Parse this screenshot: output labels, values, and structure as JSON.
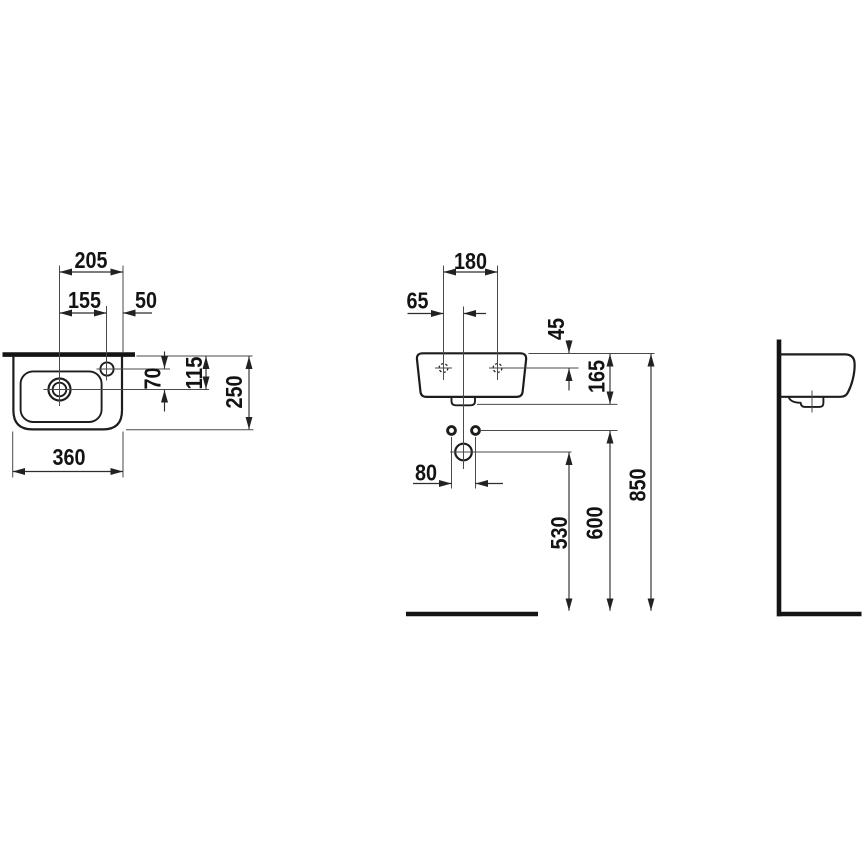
{
  "colors": {
    "outline": "#1d1d1b",
    "dimension_line": "#2e2e2e",
    "extension_line": "#4a4a4a",
    "text": "#131313",
    "background": "#ffffff"
  },
  "dims": {
    "top_view": {
      "d205": "205",
      "d155": "155",
      "d50": "50",
      "d70": "70",
      "d115": "115",
      "d250": "250",
      "d360": "360"
    },
    "front_view": {
      "d180": "180",
      "d65": "65",
      "d45": "45",
      "d165": "165",
      "d80": "80",
      "d530": "530",
      "d600": "600",
      "d850": "850"
    }
  }
}
